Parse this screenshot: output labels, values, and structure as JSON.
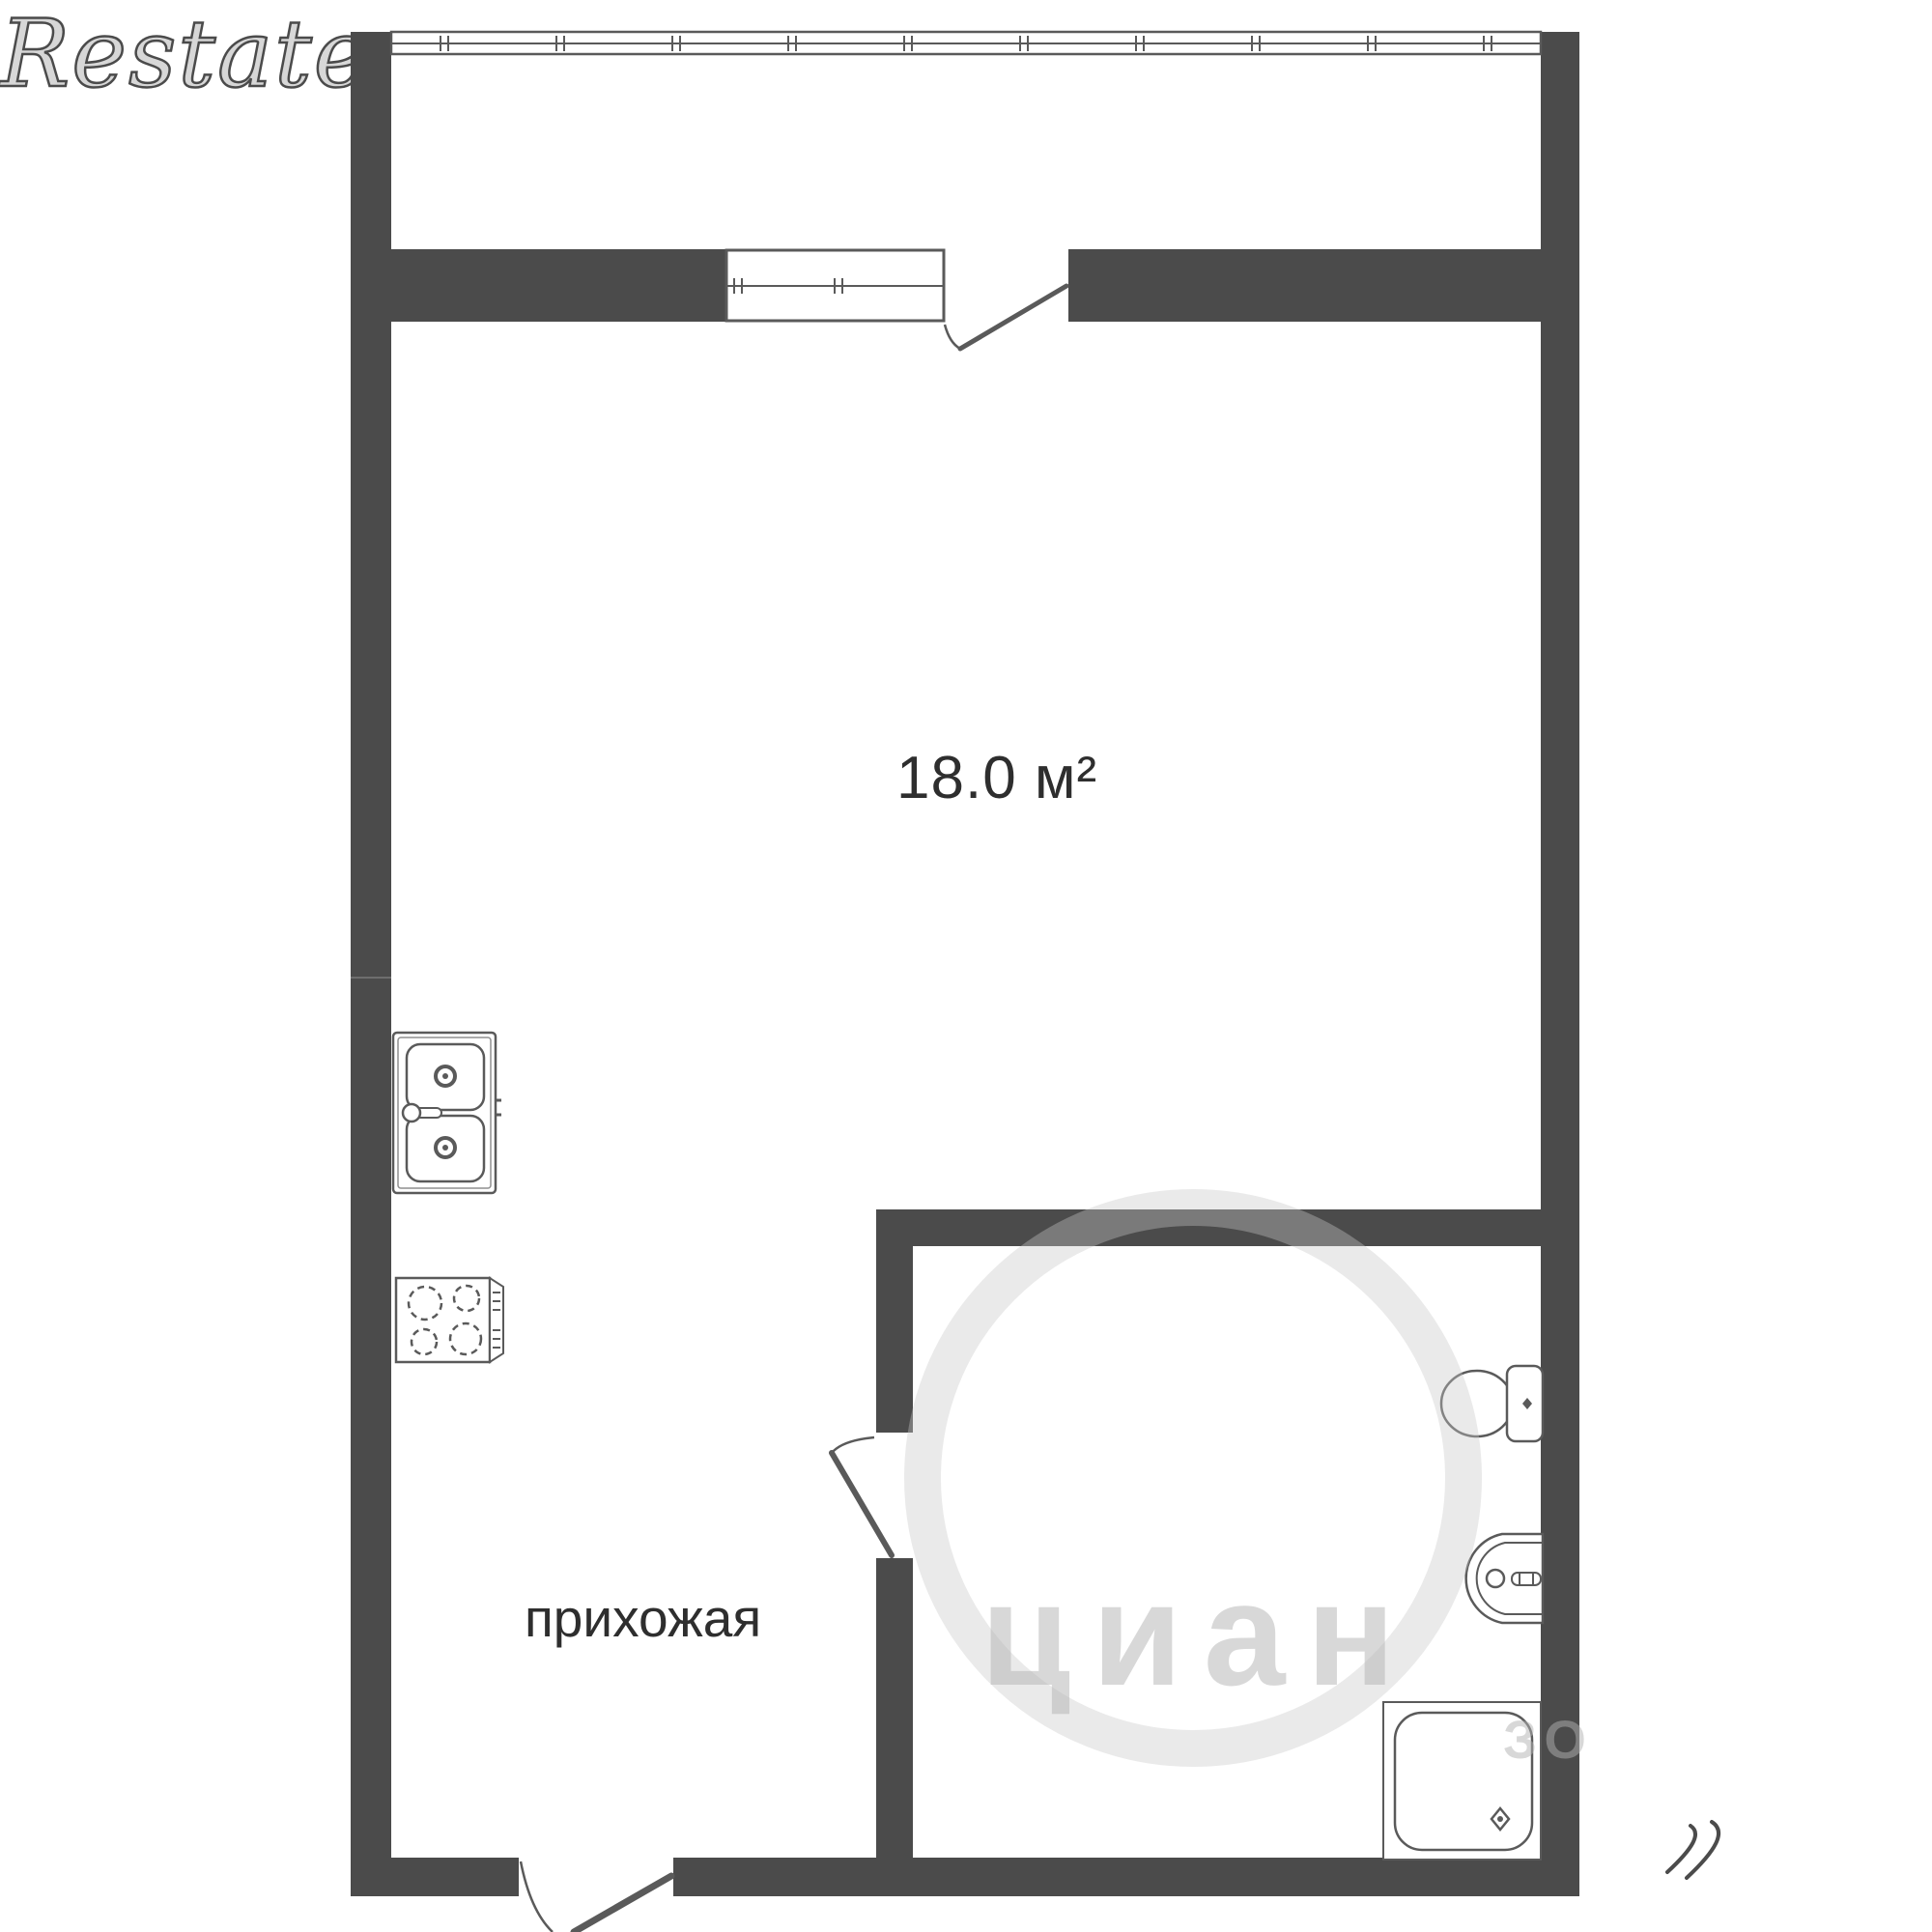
{
  "plan": {
    "type": "apartment-floor-plan"
  },
  "labels": {
    "area": "18.0 м²",
    "hallway": "прихожая"
  },
  "watermarks": {
    "brand_center": "циан",
    "brand_center_fragment": "ЗО",
    "brand_corner": "Restate"
  },
  "colors": {
    "wall": "#4b4b4b",
    "line": "#5a5a5a",
    "line_light": "#8f8f8f",
    "text": "#2e2e2e",
    "background": "#ffffff",
    "watermark": "rgba(178,178,178,0.5)"
  }
}
